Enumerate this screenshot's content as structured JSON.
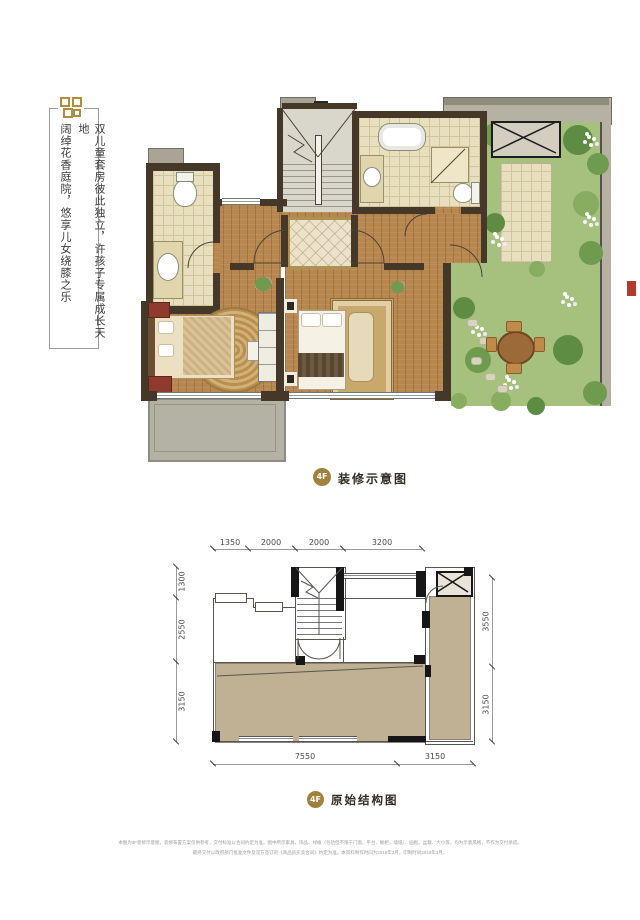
{
  "page": {
    "width": 640,
    "height": 920,
    "background": "#ffffff"
  },
  "side_note": {
    "ornament": "gold-fret-ornament",
    "primary": "双儿童套房彼此独立，许孩子专属成长天地",
    "secondary": "阔绰花香庭院，悠享儿女绕膝之乐"
  },
  "decorated_plan": {
    "badge": "4F",
    "title": "装修示意图"
  },
  "structural_plan": {
    "badge": "4F",
    "title": "原始结构图",
    "dimensions": {
      "top": [
        "1350",
        "2000",
        "2000",
        "3200"
      ],
      "left": [
        "1300",
        "2550",
        "3150"
      ],
      "right": [
        "3550",
        "3150"
      ],
      "bottom": [
        "7550",
        "3150"
      ]
    }
  },
  "footer": {
    "line1": "本图为4F装修示意图，装修布置方案仅供参考，交付标准以合同约定为准。图中所示家具、饰品、绿植（包括但不限于门窗、平台、橱柜、墙纸）、画框、盆栽、大小等，均为示意风格，不作为交付承诺。",
    "line2": "最终交付以政府部门批准文件及双方签订的《商品房买卖合同》约定为准。本资料制作时间为2019年3月，印制时间2019年3月。"
  },
  "colors": {
    "accent_gold": "#a0823c",
    "wall_brown": "#453828",
    "wood_floor": "#b7874f",
    "bath_tile": "#e7dfbd",
    "garden_green": "#a6c17d",
    "terrace_tan": "#c0b094",
    "balcony_gray": "#b4b1a5",
    "stair_gray": "#d9d6cb",
    "dimension_text": "#4a4a4a",
    "marker_red": "#b23a2f"
  }
}
